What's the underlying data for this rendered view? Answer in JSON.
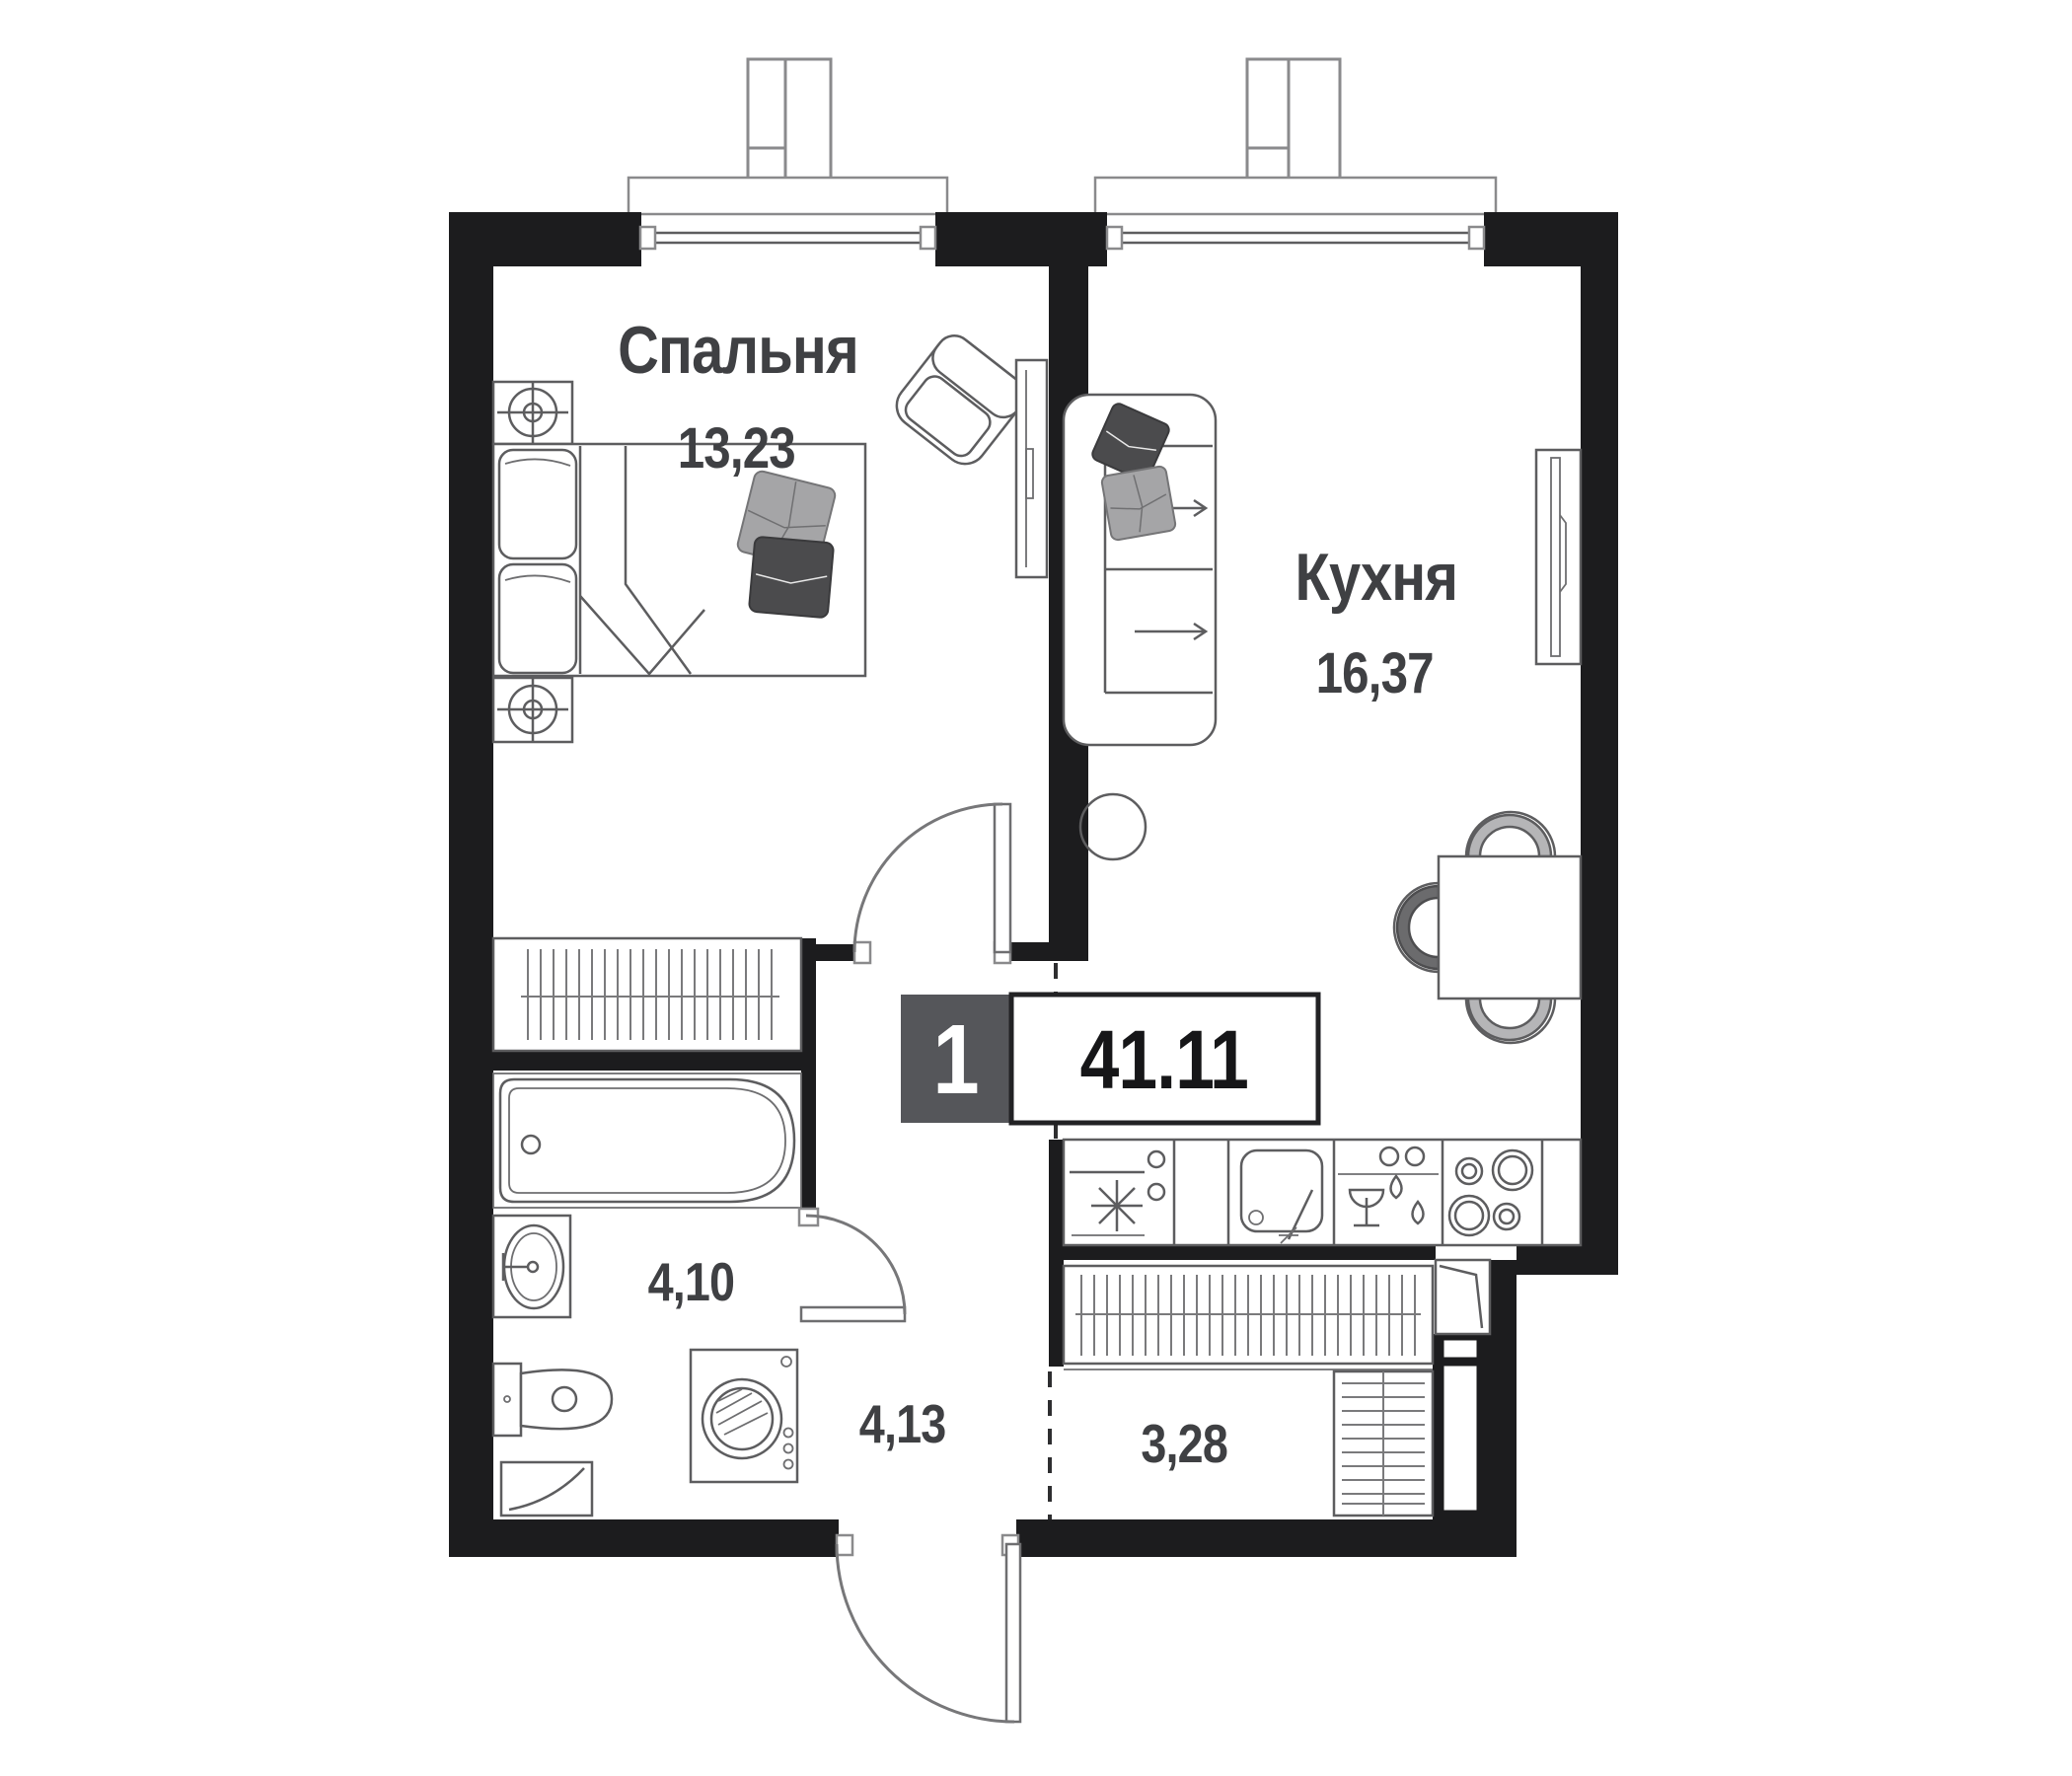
{
  "plan_type": "apartment-floor-plan",
  "rooms": {
    "bedroom": {
      "label": "Спальня",
      "area": "13,23"
    },
    "kitchen": {
      "label": "Кухня",
      "area": "16,37"
    },
    "bathroom": {
      "area": "4,10"
    },
    "hallway": {
      "area": "4,13"
    },
    "closet": {
      "area": "3,28"
    }
  },
  "summary": {
    "room_count": "1",
    "total_area": "41.11"
  },
  "colors": {
    "walls": "#1c1c1e",
    "furniture_line": "#5d5d5f",
    "label_text": "#3f4043",
    "badge_gray": "#55565a",
    "pillow_dark": "#4b4b4d",
    "pillow_light": "#a5a5a7"
  }
}
